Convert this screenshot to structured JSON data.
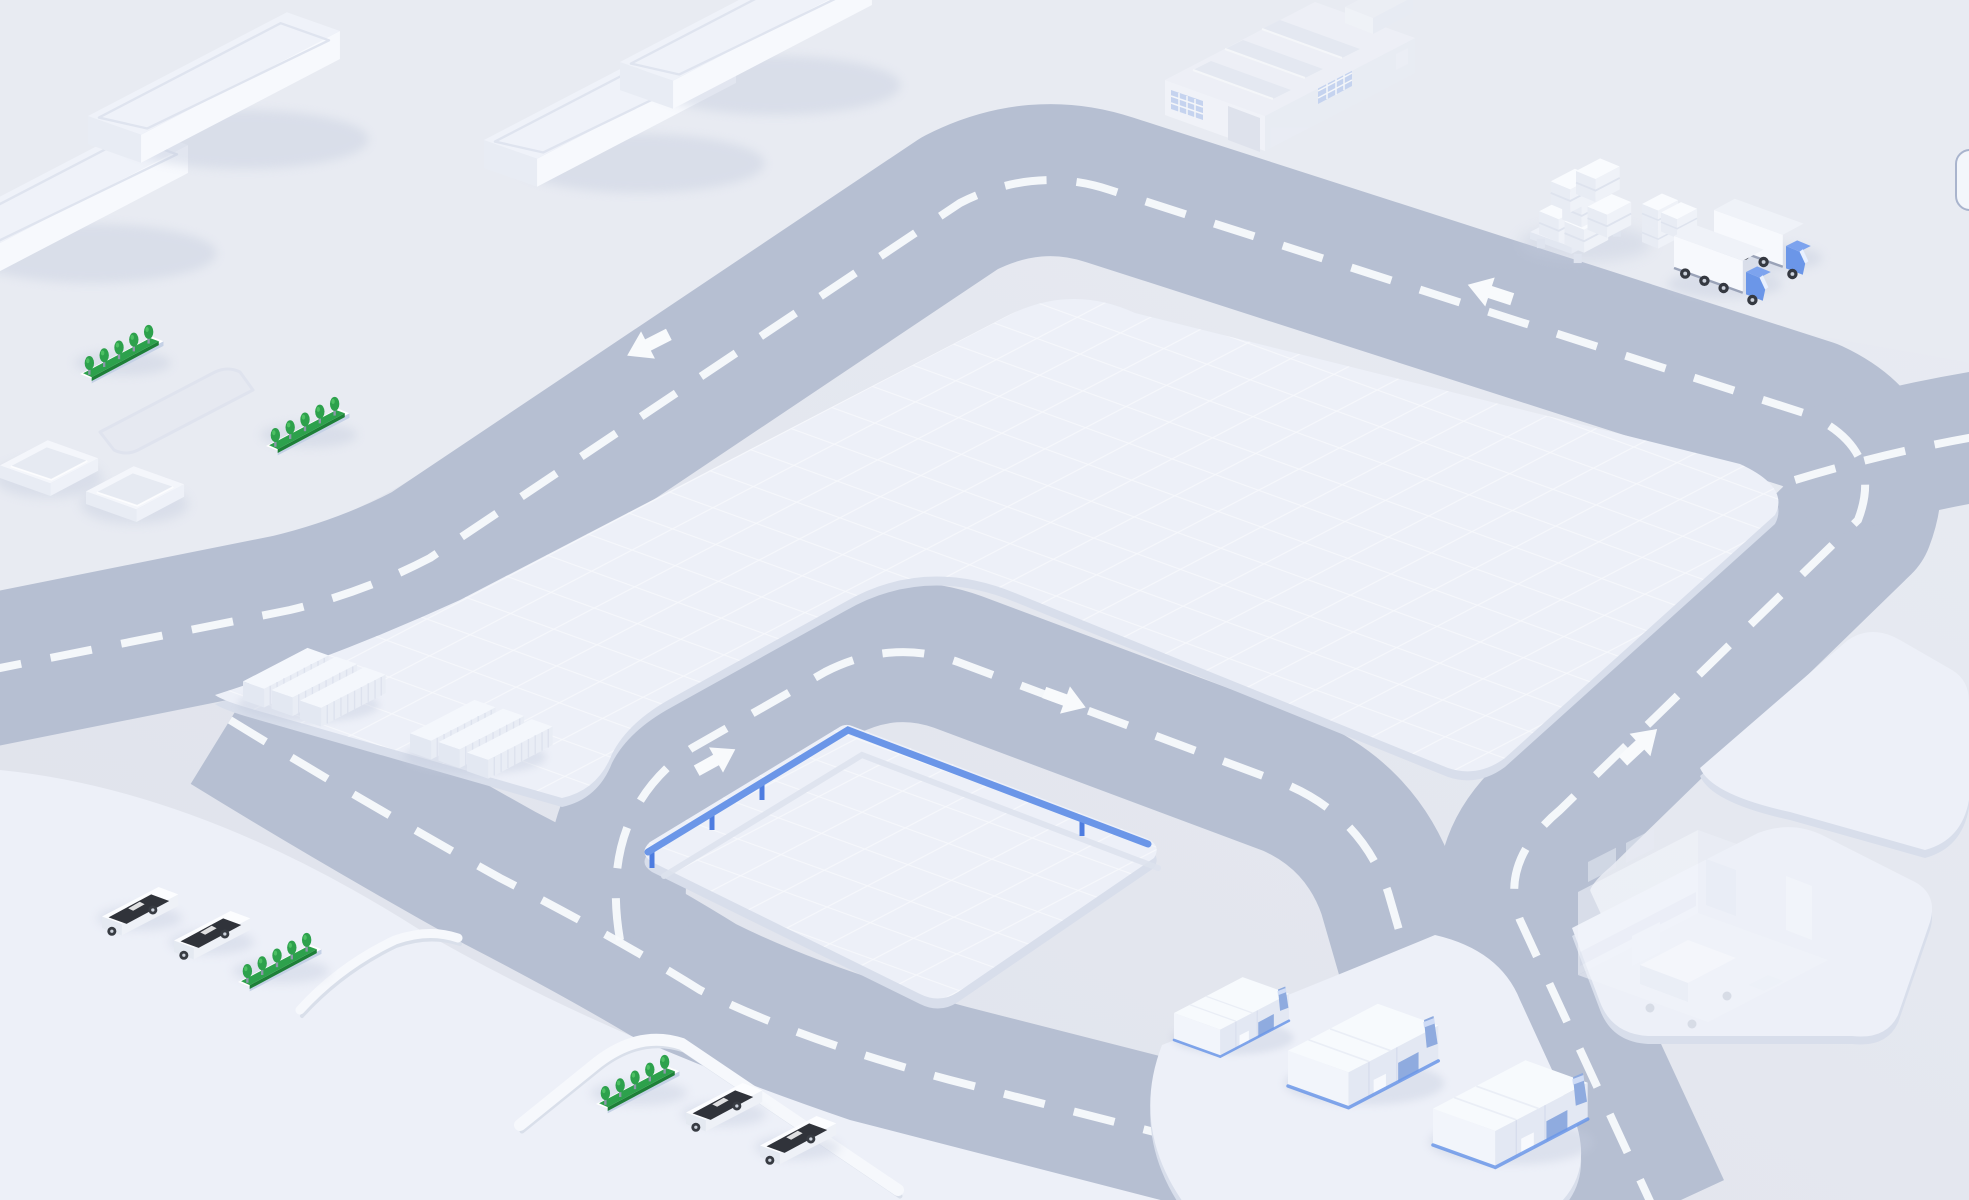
{
  "scene": {
    "type": "isometric illustration",
    "subject": "logistics campus map with ring road",
    "visible_text": "none"
  },
  "palette": {
    "background": "#e2e5ed",
    "upper_ground": "#e8ebf2",
    "road": "#b6bfd2",
    "road_dash": "#f8fafc",
    "platform": "#edf0f8",
    "platform_lip": "#d8deeb",
    "grid_line": "#ffffff",
    "accent_blue": "#6b96e8",
    "accent_blue_dark": "#4d7ce0",
    "accent_blue_soft": "#8fabdf",
    "tree_green": "#2da14c",
    "tree_green_dark": "#1e8038",
    "car_glass": "#30333a",
    "wheel": "#373b42",
    "white": "#ffffff",
    "shadow": "#c3cbdd"
  },
  "roads": {
    "style": "gray-blue bands with white dashed center lines",
    "arrows": [
      {
        "id": "arrow-top-left",
        "direction": "left-down"
      },
      {
        "id": "arrow-top-right",
        "direction": "left"
      },
      {
        "id": "arrow-right-straight",
        "direction": "up-right"
      },
      {
        "id": "arrow-inner-west",
        "direction": "up-right"
      },
      {
        "id": "arrow-inner-east",
        "direction": "right-down"
      }
    ]
  },
  "areas": [
    {
      "id": "upper-ground",
      "note": "light ground holding slab buildings, factory, pallets, trucks"
    },
    {
      "id": "main-platform",
      "surface": "fine white grid"
    },
    {
      "id": "inner-platform",
      "surface": "fine white grid",
      "feature": "blue guardrail on two edges"
    },
    {
      "id": "parking-platform",
      "note": "bottom-left, holds cars, hedges, curbs"
    },
    {
      "id": "warehouse-pad",
      "note": "holds three blue-accent warehouses"
    },
    {
      "id": "hospital-pad",
      "note": "holds ghosted hospital room"
    },
    {
      "id": "east-pad",
      "note": "empty trapezoid pad at right"
    }
  ],
  "props": {
    "slab_buildings": {
      "count": 4,
      "style": "long white boxes with inset roof border"
    },
    "factory": {
      "count": 1,
      "style": "ghosted",
      "windows": "blue grids",
      "skylights": 3,
      "rooftop_box": 1
    },
    "pallets": {
      "count": 2,
      "load": "stacked white boxes"
    },
    "trucks": {
      "count": 2,
      "cab_color": "#6b96e8",
      "trailer": "white box"
    },
    "container_groups": {
      "count": 2,
      "containers_per_group": 3,
      "style": "white ribbed"
    },
    "hedges": {
      "count": 4,
      "trees_per_hedge": 5
    },
    "cars": {
      "count": 4,
      "body": "white",
      "glass": "black"
    },
    "square_pads": {
      "count": 2
    },
    "parking_recess": {
      "count": 1
    },
    "curbs": {
      "count": 2
    },
    "warehouses": {
      "count": 3,
      "accents": "blue base strip, blue door, blue chimney"
    },
    "hospital_room": {
      "count": 1,
      "style": "ghosted",
      "contents": "bed on wheels, wall cabinets"
    },
    "guardrail": {
      "color": "#6b96e8",
      "posts": 4
    }
  },
  "controls": {
    "edge_widget": {
      "position": "right edge",
      "shape": "rounded rectangle",
      "state": "mostly clipped off-screen"
    }
  }
}
